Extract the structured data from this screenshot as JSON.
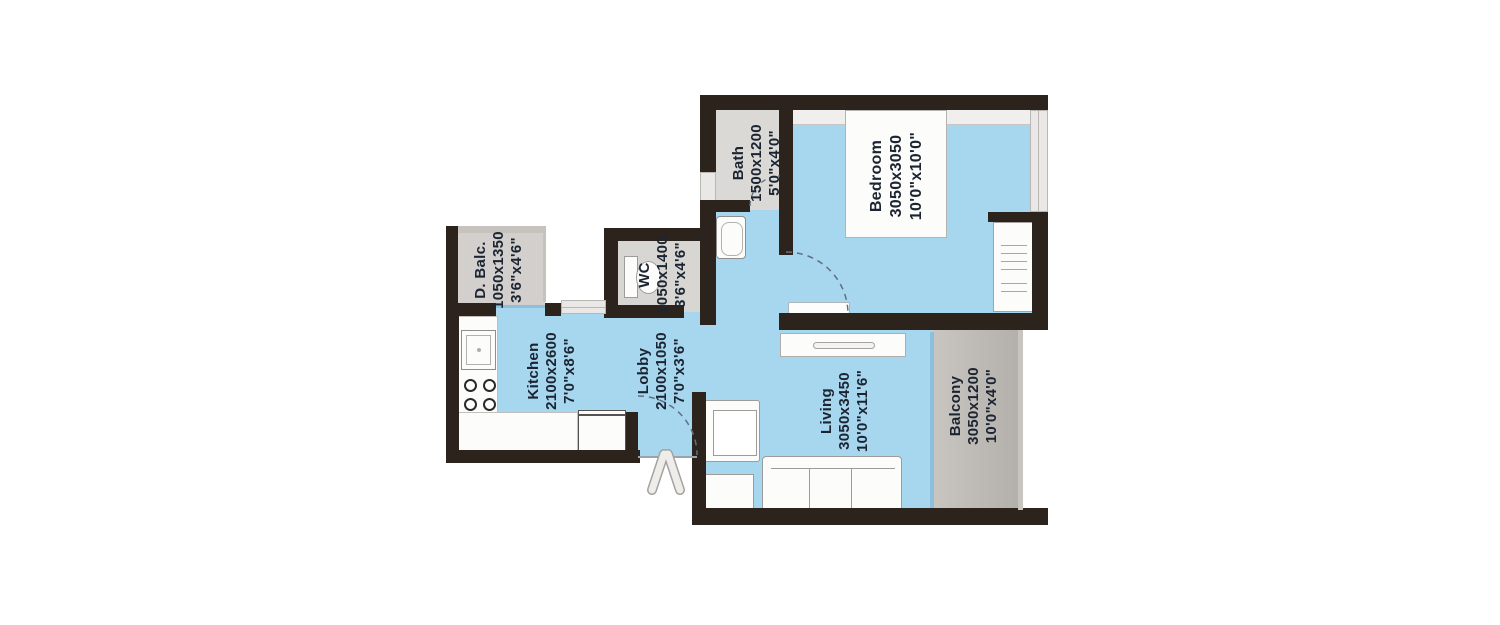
{
  "plan_title": "1 BHK apartment floor plan",
  "colors": {
    "floor_blue": "#a7d6ef",
    "floor_gray": "#d8d6d3",
    "balcony_gray": "#bdb9b5",
    "wall_dark": "#2c231d",
    "glass_teal": "#8cc0dc",
    "label_text": "#1b2431",
    "furniture_white": "#fcfcfb",
    "background": "#ffffff"
  },
  "rooms": [
    {
      "id": "bath",
      "name": "Bath",
      "dim_mm": "1500x1200",
      "dim_ft": "5'0\"x4'0\""
    },
    {
      "id": "bedroom",
      "name": "Bedroom",
      "dim_mm": "3050x3050",
      "dim_ft": "10'0\"x10'0\""
    },
    {
      "id": "wc",
      "name": "WC",
      "dim_mm": "1050x1400",
      "dim_ft": "3'6\"x4'6\""
    },
    {
      "id": "dry_balcony",
      "name": "D. Balc.",
      "dim_mm": "1050x1350",
      "dim_ft": "3'6\"x4'6\""
    },
    {
      "id": "kitchen",
      "name": "Kitchen",
      "dim_mm": "2100x2600",
      "dim_ft": "7'0\"x8'6\""
    },
    {
      "id": "lobby",
      "name": "Lobby",
      "dim_mm": "2100x1050",
      "dim_ft": "7'0\"x3'6\""
    },
    {
      "id": "living",
      "name": "Living",
      "dim_mm": "3050x3450",
      "dim_ft": "10'0\"x11'6\""
    },
    {
      "id": "balcony",
      "name": "Balcony",
      "dim_mm": "3050x1200",
      "dim_ft": "10'0\"x4'0\""
    }
  ],
  "fixtures": [
    "bed",
    "wardrobe",
    "tv-console",
    "tv-unit",
    "armchair",
    "side-table",
    "sofa",
    "kitchen-sink",
    "stove",
    "refrigerator",
    "kitchen-counter",
    "wash-basin",
    "toilet",
    "entrance-arrow",
    "door-swing-arcs",
    "windows",
    "balcony-railing"
  ]
}
